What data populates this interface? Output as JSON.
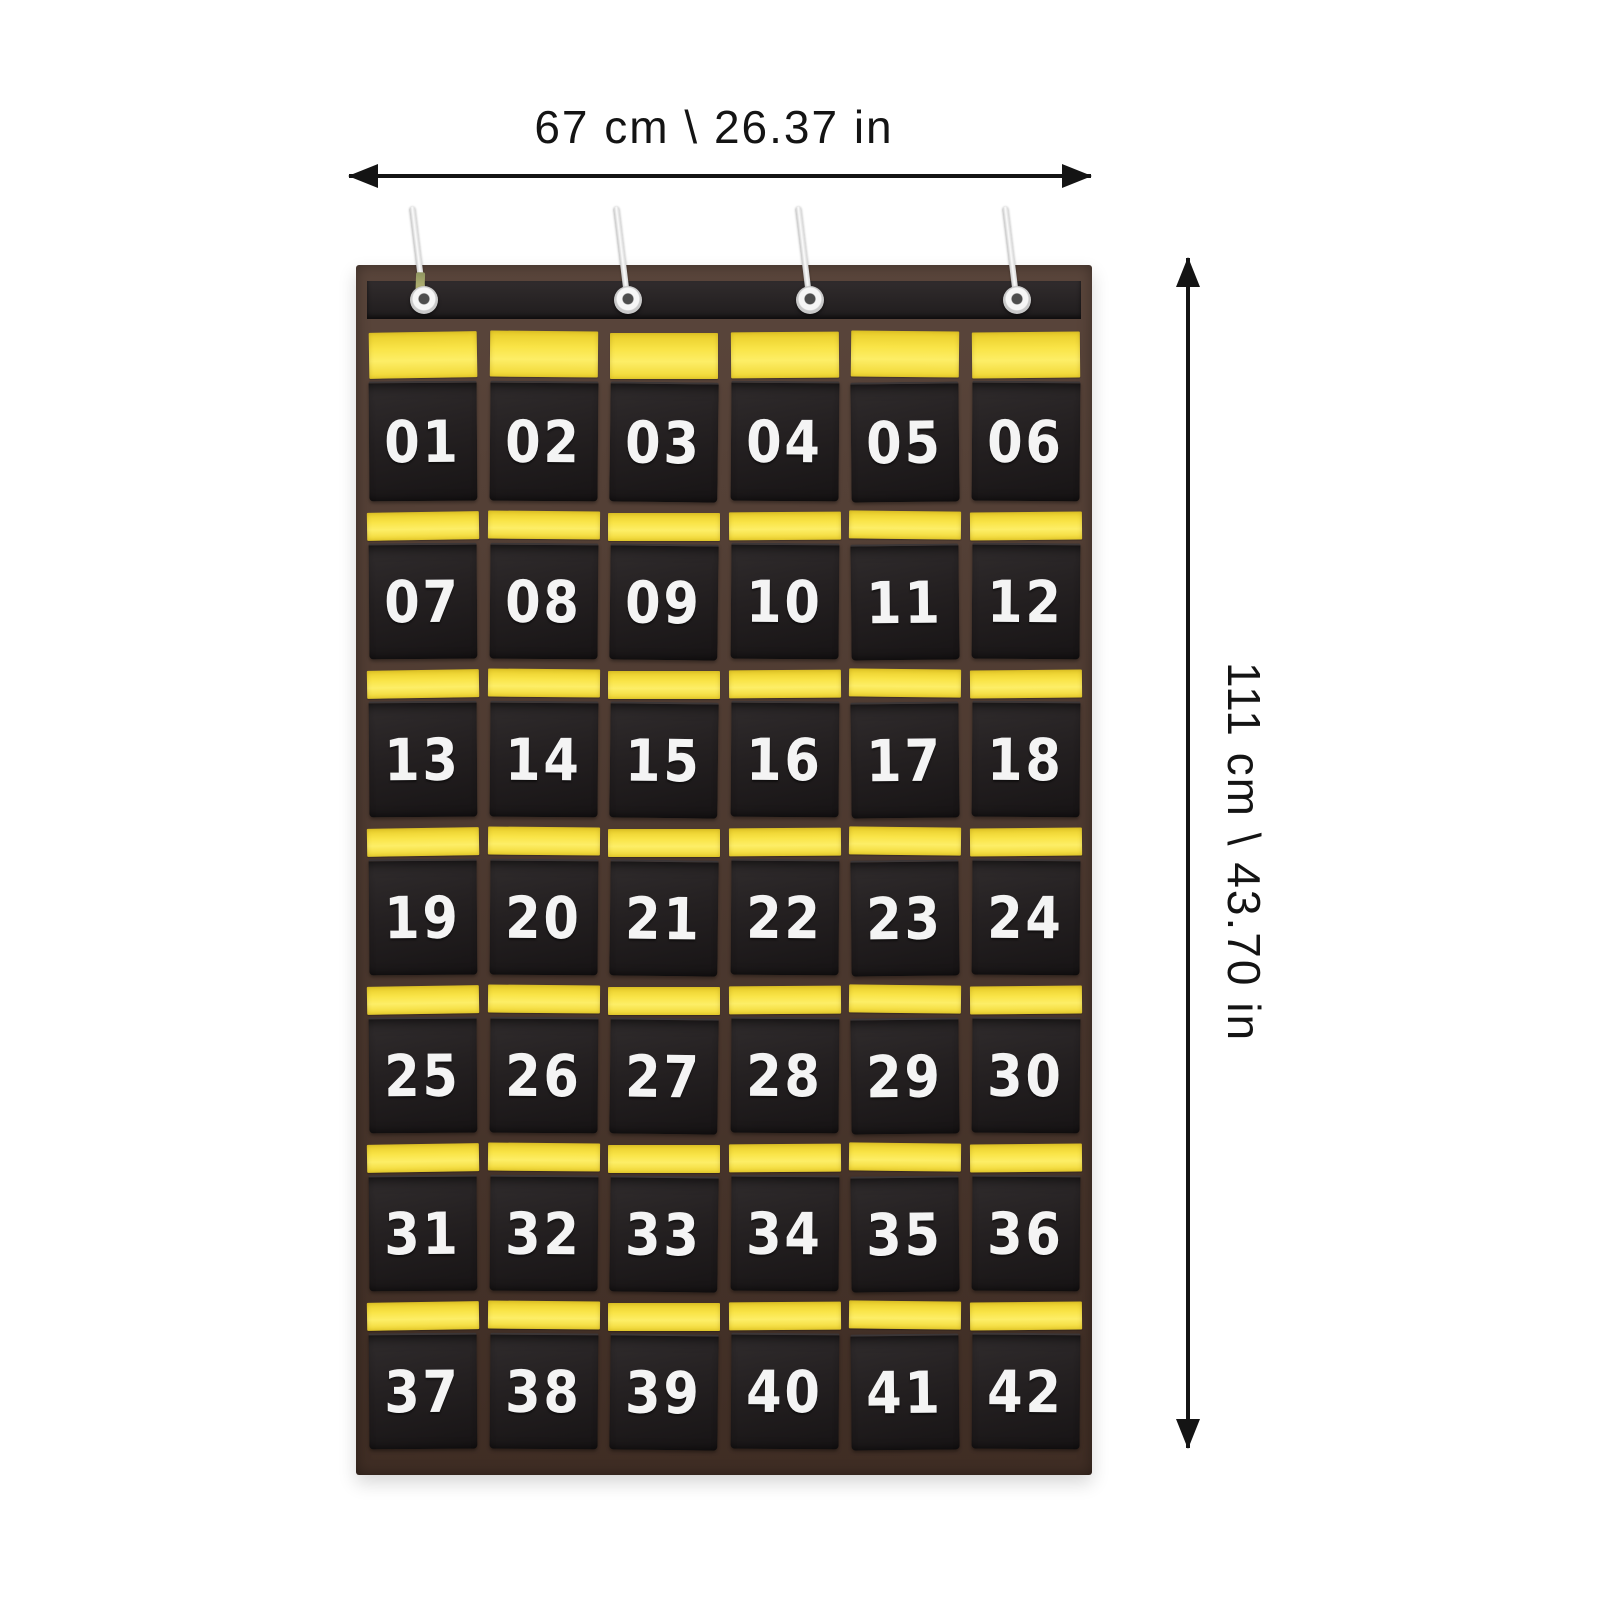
{
  "annotations": {
    "width_label": "67 cm \\ 26.37 in",
    "height_label": "111 cm \\ 43.70 in"
  },
  "organizer": {
    "hook_count": 4,
    "hook_positions_pct": [
      8,
      36.5,
      62,
      91
    ],
    "rows": [
      [
        "01",
        "02",
        "03",
        "04",
        "05",
        "06"
      ],
      [
        "07",
        "08",
        "09",
        "10",
        "11",
        "12"
      ],
      [
        "13",
        "14",
        "15",
        "16",
        "17",
        "18"
      ],
      [
        "19",
        "20",
        "21",
        "22",
        "23",
        "24"
      ],
      [
        "25",
        "26",
        "27",
        "28",
        "29",
        "30"
      ],
      [
        "31",
        "32",
        "33",
        "34",
        "35",
        "36"
      ],
      [
        "37",
        "38",
        "39",
        "40",
        "41",
        "42"
      ]
    ],
    "icons": {
      "hanging_hook": "wire-s-hook",
      "grommet": "metal-eyelet",
      "width_arrow": "double-headed-arrow-horizontal",
      "height_arrow": "double-headed-arrow-vertical"
    },
    "colors": {
      "fabric_black": "#242021",
      "trim_brown": "#4d372c",
      "insert_yellow": "#f6dd33",
      "number_white": "#f4f4f4",
      "hook_silver": "#e6e6e6",
      "dimension_ink": "#141414"
    }
  }
}
